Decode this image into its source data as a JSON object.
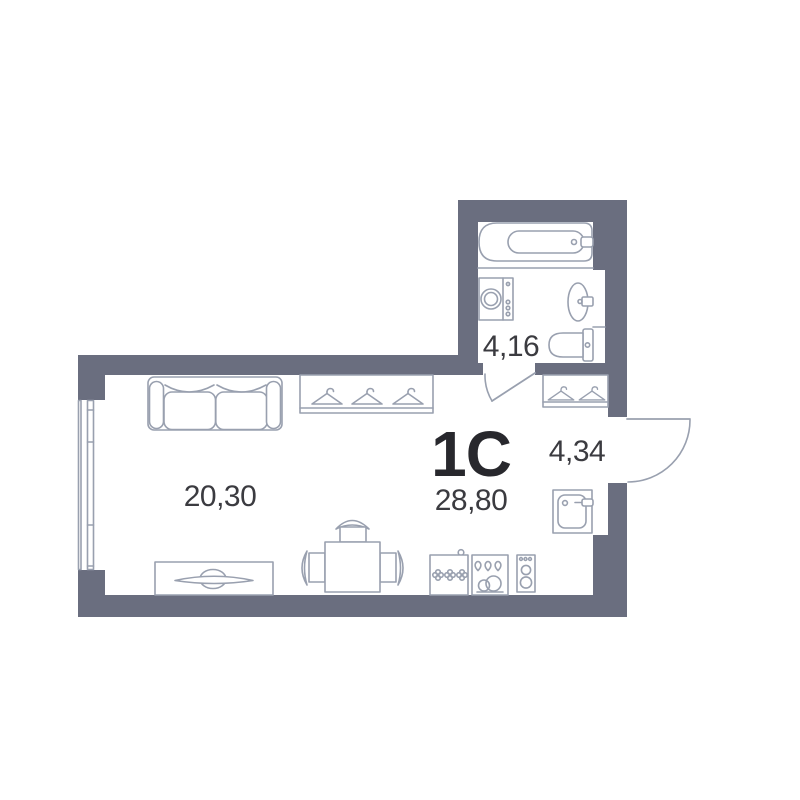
{
  "plan": {
    "unit_label": "1C",
    "total_area": "28,80",
    "living_area": "20,30",
    "bathroom_area": "4,16",
    "hallway_area": "4,34"
  },
  "colors": {
    "wall": "#6a6e7f",
    "furniture_stroke": "#99a0af",
    "text_dark": "#28282d",
    "text_label": "#3b3b40",
    "background": "#ffffff"
  },
  "icons": [
    "window-icon",
    "entry-door-icon",
    "interior-door-icon",
    "bathtub-icon",
    "washing-machine-icon",
    "wash-basin-icon",
    "toilet-icon",
    "coat-hanger-icon",
    "hallway-wardrobe-icon",
    "wardrobe-icon",
    "sofa-icon",
    "tv-stand-icon",
    "dining-table-icon",
    "chair-icon",
    "hob-unit-icon",
    "kitchen-sink-unit-icon",
    "oven-icon",
    "kitchen-wall-sink-icon"
  ]
}
